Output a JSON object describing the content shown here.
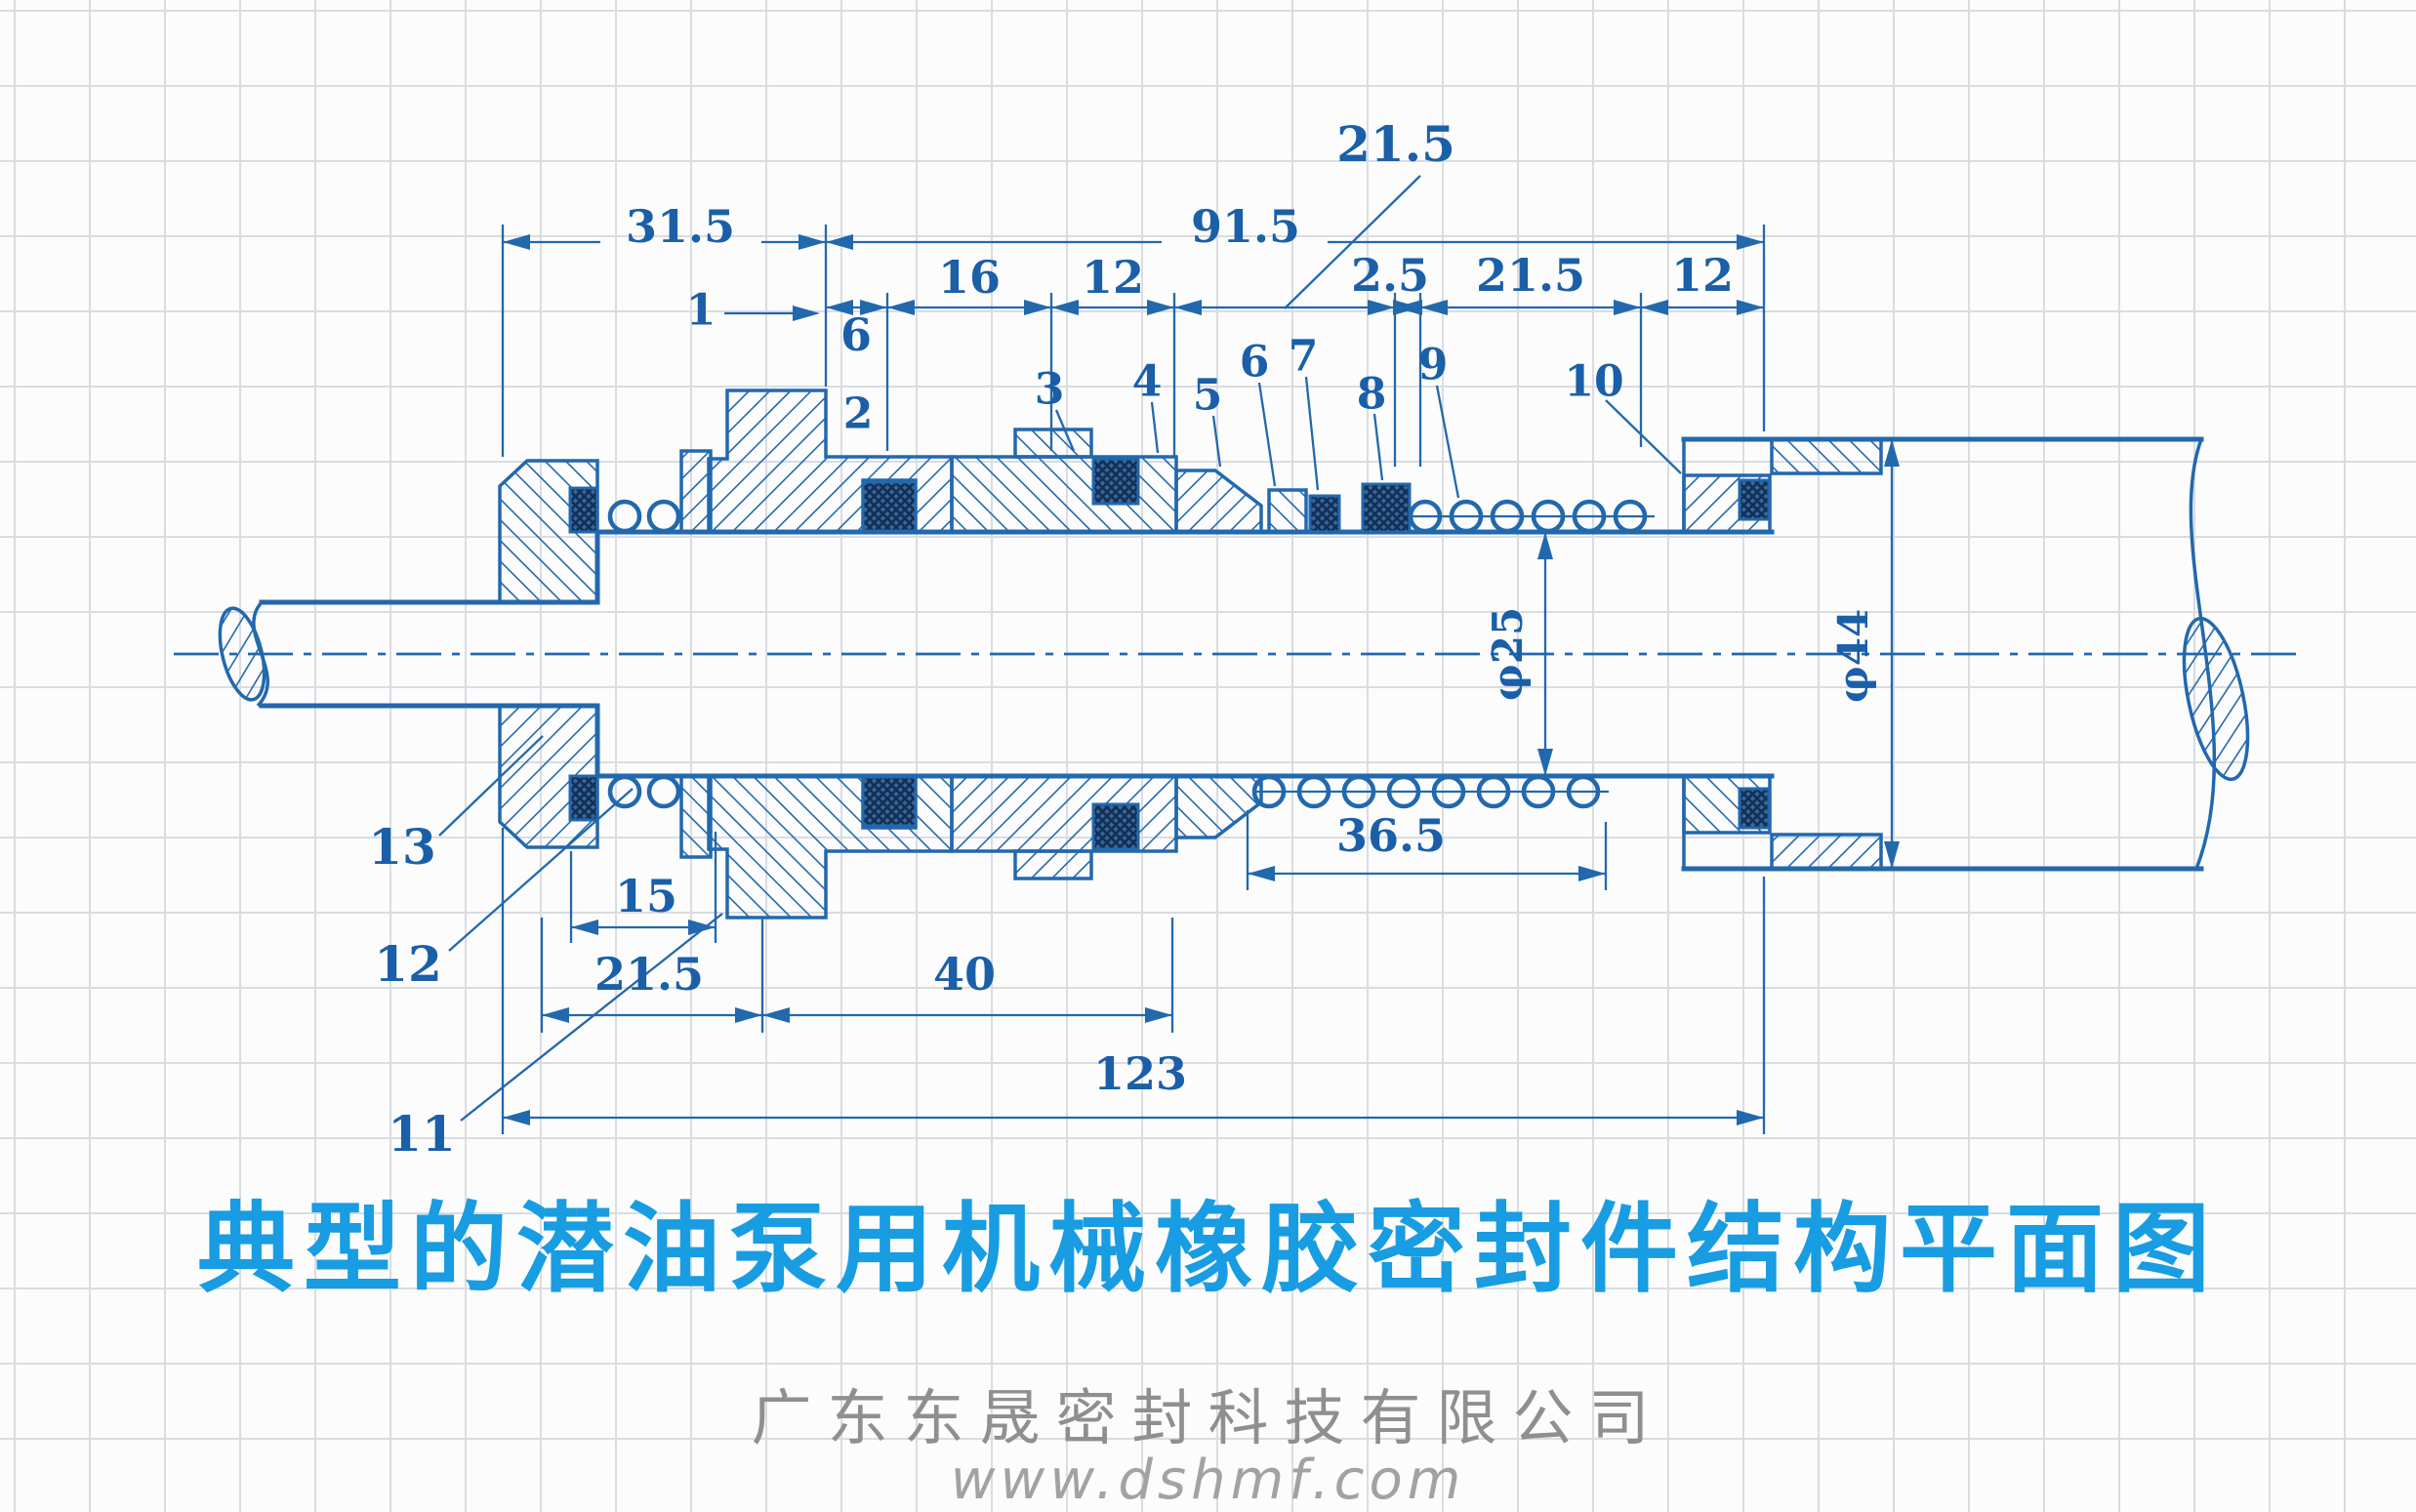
{
  "page": {
    "caption": "典型的潜油泵用机械橡胶密封件结构平面图",
    "footer": {
      "company": "广东东晟密封科技有限公司",
      "website": "www.dshmf.com"
    }
  },
  "diagram": {
    "top_dimensions": {
      "d31_5": "31.5",
      "d91_5": "91.5",
      "d21_5_leader": "21.5"
    },
    "chain_dimensions": {
      "d6": "6",
      "d16": "16",
      "d12_a": "12",
      "d2_5": "2.5",
      "d21_5": "21.5",
      "d12_b": "12"
    },
    "bottom_dimensions": {
      "d15": "15",
      "d21_5": "21.5",
      "d40": "40",
      "d36_5": "36.5",
      "d123": "123"
    },
    "diameters": {
      "shaft": "φ25",
      "sleeve": "φ44"
    },
    "parts": {
      "p1": "1",
      "p2": "2",
      "p3": "3",
      "p4": "4",
      "p5": "5",
      "p6": "6",
      "p7": "7",
      "p8": "8",
      "p9": "9",
      "p10": "10",
      "p11": "11",
      "p12": "12",
      "p13": "13"
    }
  },
  "colors": {
    "ink": "#2268ad",
    "ink_dark": "#1a5fa8",
    "rubber": "#16406e",
    "title": "#189ce2",
    "footer": "#8f8f8f",
    "grid": "#d9dce0",
    "paper": "#fcfcfd"
  }
}
